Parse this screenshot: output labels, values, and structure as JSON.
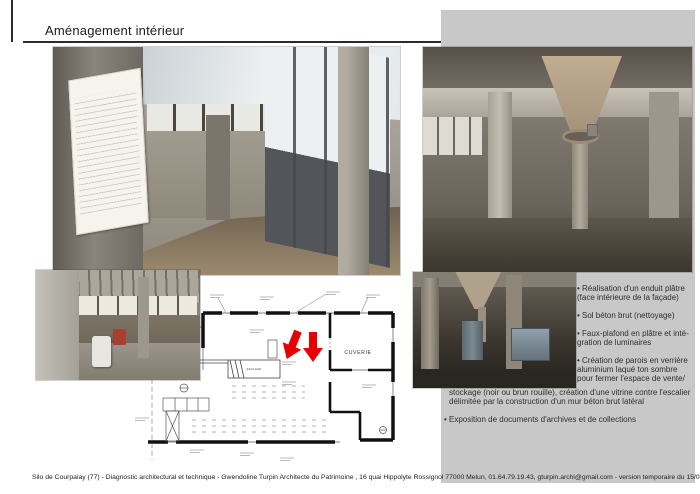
{
  "page": {
    "title": "Aménagement intérieur",
    "footer": "Silo de Courpalay (77) - Diagnostic architectural et technique - Gwendoline Turpin Architecte du Patrimoine , 16 quai Hippolyte Rossignol 77000 Melun, 01.64.79.19.43, gturpin.archi@gmail.com - version temporaire du 15/06/2013"
  },
  "notes": {
    "column_lines": [
      "• Réalisation d'un enduit plâtre",
      "(face intérieure de la façade)",
      "• Sol béton brut (nettoyage)",
      "• Faux-plafond en plâtre et inté-",
      "gration de luminaires",
      "• Création de parois en verrière",
      "aluminium laqué ton sombre",
      "pour fermer l'espace de vente/"
    ],
    "full_width_lines": [
      "stockage (noir ou brun rouille), création d'une vitrine contre l'escalier",
      "délimitée par la construction d'un mur béton brut latéral",
      "• Exposition de documents d'archives et de collections"
    ]
  },
  "plan": {
    "room_label": "CUVERIE",
    "stair_label": "ESCALIER"
  },
  "colors": {
    "panel-gray": "#c8c8c8",
    "arrow-red": "#e60000",
    "rule-dark": "#2b2b2b",
    "text-dark": "#2e2e2e"
  }
}
